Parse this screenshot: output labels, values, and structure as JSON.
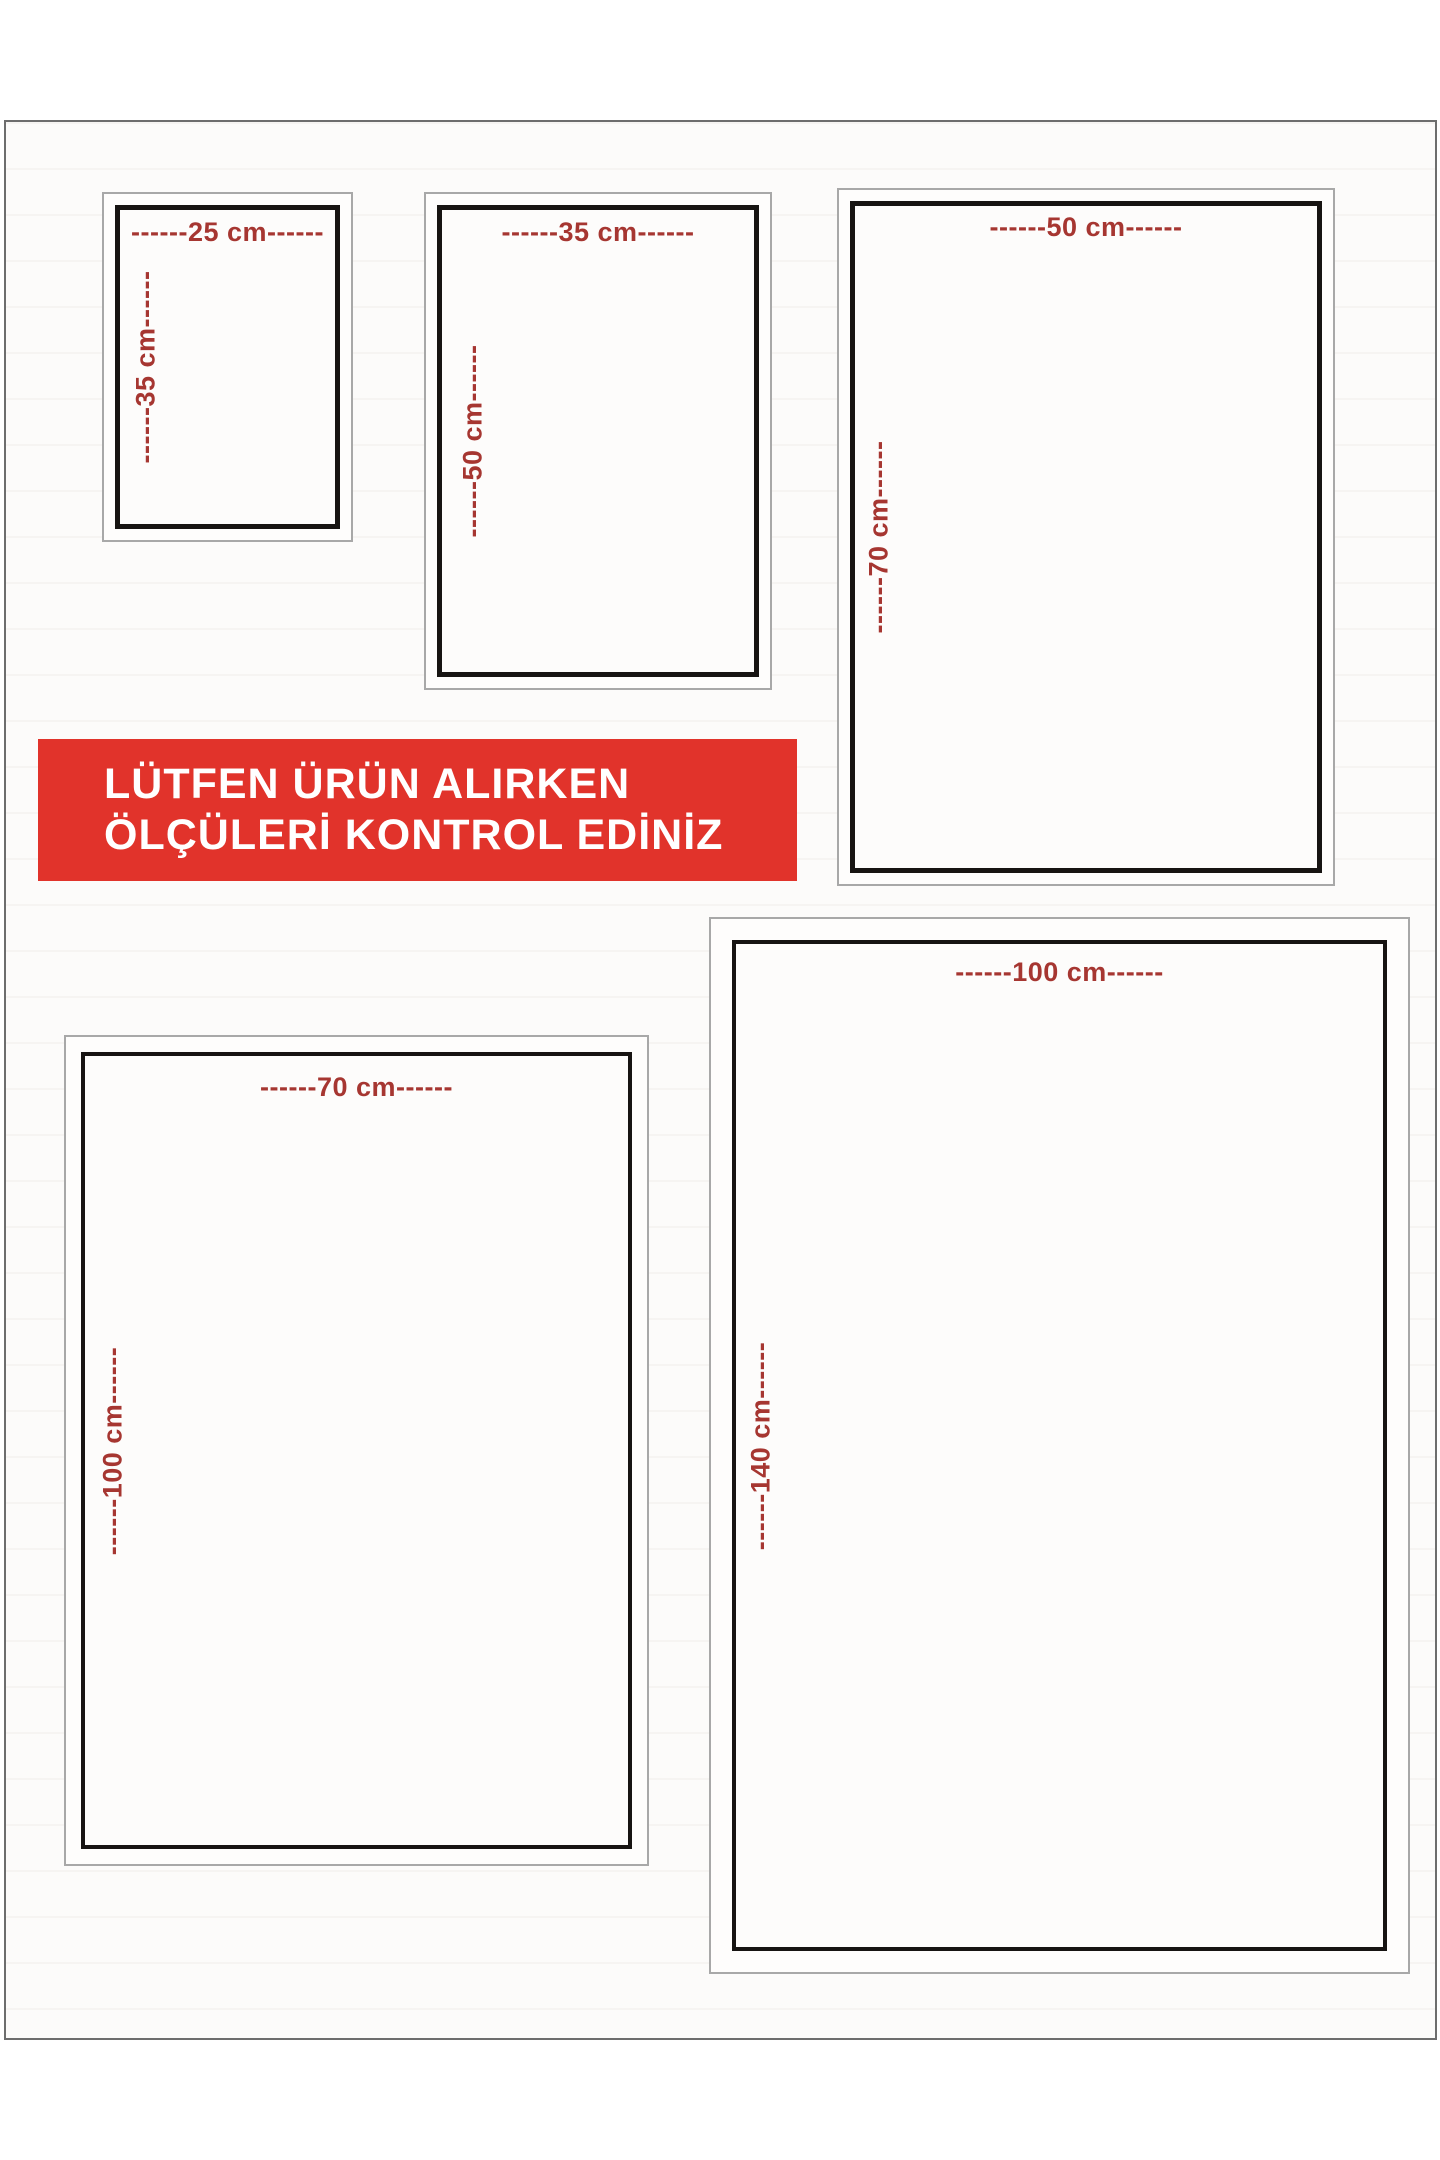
{
  "banner": {
    "line1": "LÜTFEN ÜRÜN ALIRKEN",
    "line2": "ÖLÇÜLERİ KONTROL EDİNİZ"
  },
  "size_boxes": [
    {
      "name": "25x35",
      "width_cm": "25 cm",
      "height_cm": "35 cm",
      "width_label": "------25 cm------",
      "height_label": "------35 cm------"
    },
    {
      "name": "35x50",
      "width_cm": "35 cm",
      "height_cm": "50 cm",
      "width_label": "------35 cm------",
      "height_label": "------50 cm------"
    },
    {
      "name": "50x70",
      "width_cm": "50 cm",
      "height_cm": "70 cm",
      "width_label": "------50 cm------",
      "height_label": "------70 cm------"
    },
    {
      "name": "70x100",
      "width_cm": "70 cm",
      "height_cm": "100 cm",
      "width_label": "------70 cm------",
      "height_label": "------100 cm------"
    },
    {
      "name": "100x140",
      "width_cm": "100 cm",
      "height_cm": "140 cm",
      "width_label": "------100 cm------",
      "height_label": "------140 cm------"
    }
  ],
  "colors": {
    "banner_bg": "#e1332b",
    "banner_text": "#ffffff",
    "dimension_text": "#a63631",
    "frame_dark": "#171412",
    "frame_light": "#a8a8a8",
    "page_border": "#6d6d6d",
    "page_bg": "#fcfbfa"
  }
}
